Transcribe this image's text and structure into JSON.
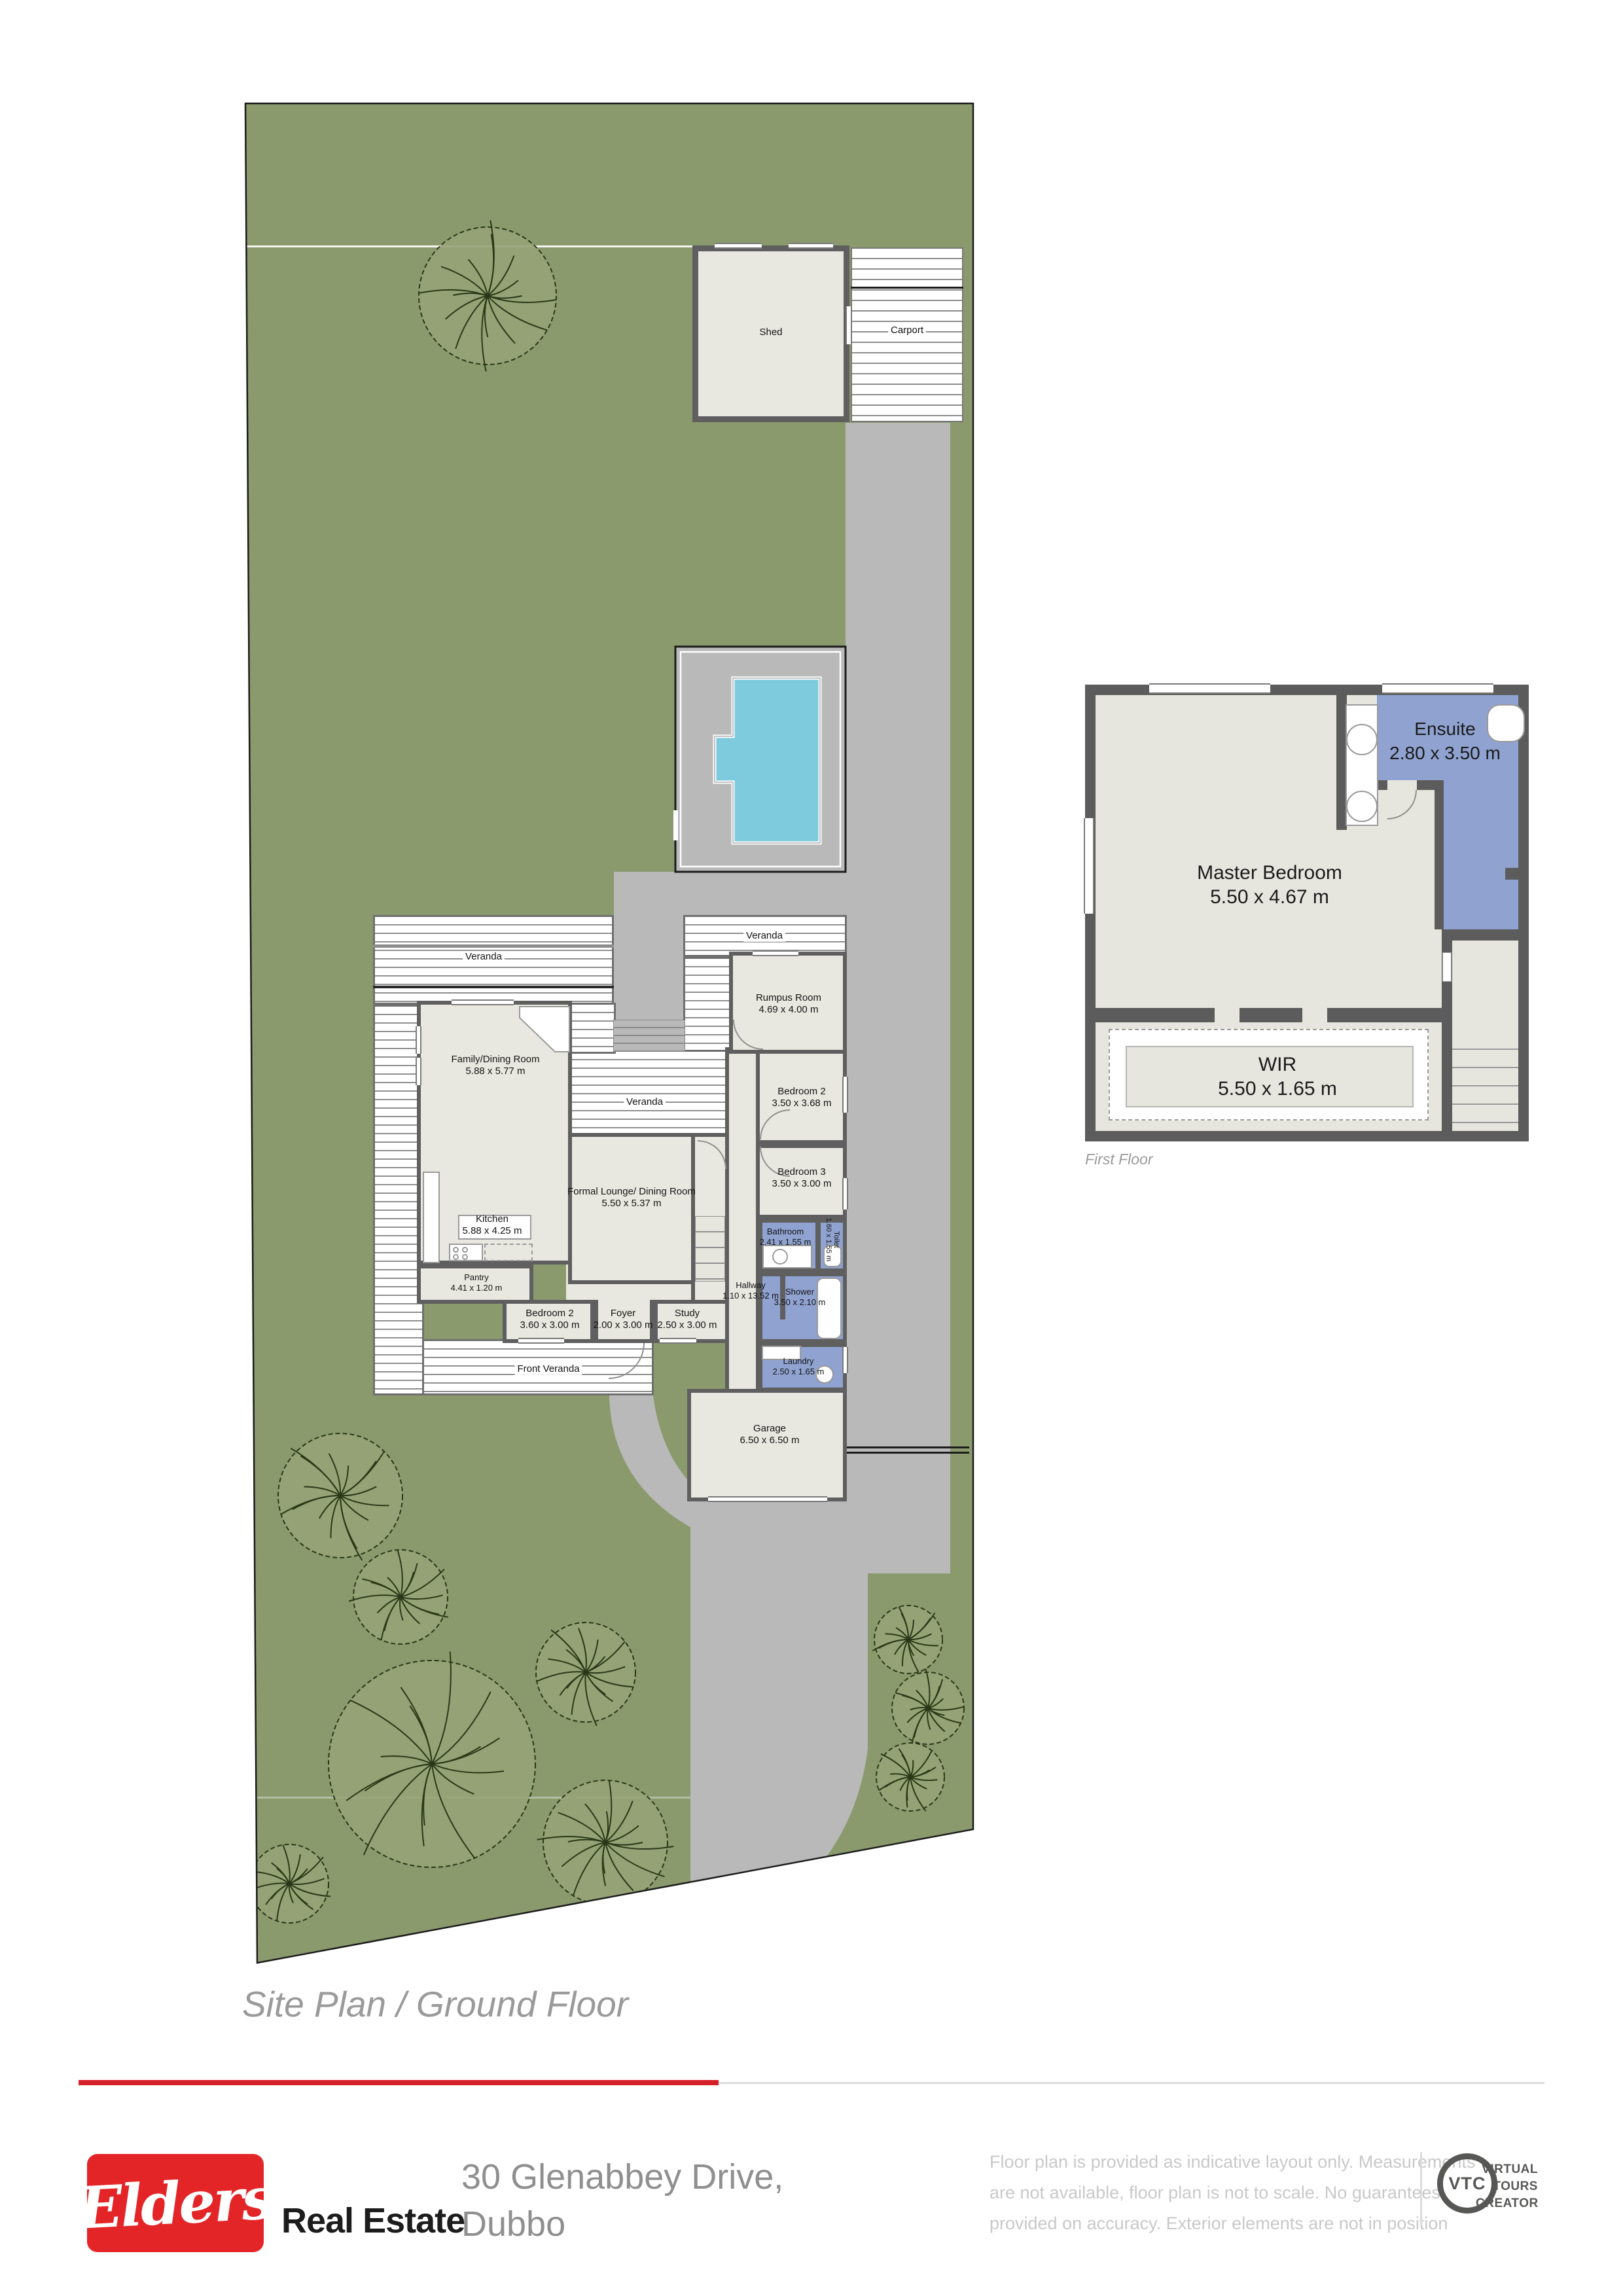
{
  "site_plan": {
    "caption": "Site Plan / Ground Floor",
    "labels": {
      "shed": "Shed",
      "carport": "Carport",
      "veranda": "Veranda",
      "front_veranda": "Front Veranda"
    },
    "rooms": {
      "family": {
        "name": "Family/Dining Room",
        "dims": "5.88 x 5.77 m"
      },
      "kitchen": {
        "name": "Kitchen",
        "dims": "5.88 x 4.25 m"
      },
      "pantry": {
        "name": "Pantry",
        "dims": "4.41 x 1.20 m"
      },
      "formal_lounge": {
        "name": "Formal Lounge/ Dining Room",
        "dims": "5.50 x 5.37 m"
      },
      "rumpus": {
        "name": "Rumpus Room",
        "dims": "4.69 x 4.00 m"
      },
      "bedroom2": {
        "name": "Bedroom 2",
        "dims": "3.50 x 3.68 m"
      },
      "bedroom3": {
        "name": "Bedroom 3",
        "dims": "3.50 x 3.00 m"
      },
      "bedroom2_lower": {
        "name": "Bedroom 2",
        "dims": "3.60 x 3.00 m"
      },
      "foyer": {
        "name": "Foyer",
        "dims": "2.00 x 3.00 m"
      },
      "study": {
        "name": "Study",
        "dims": "2.50 x 3.00 m"
      },
      "hallway": {
        "name": "Hallway",
        "dims": "1.10 x 13.52 m"
      },
      "bathroom": {
        "name": "Bathroom",
        "dims": "2.41 x 1.55 m"
      },
      "toilet": {
        "name": "Toilet",
        "dims": "1.60 x 1.55 m"
      },
      "shower": {
        "name": "Shower",
        "dims": "3.50 x 2.10 m"
      },
      "laundry": {
        "name": "Laundry",
        "dims": "2.50 x 1.65 m"
      },
      "garage": {
        "name": "Garage",
        "dims": "6.50 x 6.50 m"
      }
    }
  },
  "first_floor": {
    "caption": "First Floor",
    "rooms": {
      "master": {
        "name": "Master Bedroom",
        "dims": "5.50 x 4.67 m"
      },
      "ensuite": {
        "name": "Ensuite",
        "dims": "2.80 x 3.50 m"
      },
      "wir": {
        "name": "WIR",
        "dims": "5.50 x 1.65 m"
      }
    }
  },
  "footer": {
    "brand": "Elders",
    "brand_suffix": "Real Estate",
    "address_line1": "30 Glenabbey Drive,",
    "address_line2": "Dubbo",
    "disclaimer_line1": "Floor plan is provided as indicative layout only. Measurements",
    "disclaimer_line2": "are not available, floor plan is not to scale. No guarantees",
    "disclaimer_line3": "provided on accuracy. Exterior elements are not in position",
    "vtc": {
      "abbr": "VTC",
      "line1": "VIRTUAL",
      "line2": "TOURS",
      "line3": "CREATOR"
    }
  },
  "colors": {
    "lawn": "#8b9a6d",
    "driveway": "#b9b9b9",
    "floor": "#e9e8e0",
    "wall": "#5f5f5f",
    "wet_area": "#8fa2d0",
    "pool": "#7dcbdd",
    "brand_red": "#e42528",
    "caption_gray": "#9a9a9a"
  }
}
